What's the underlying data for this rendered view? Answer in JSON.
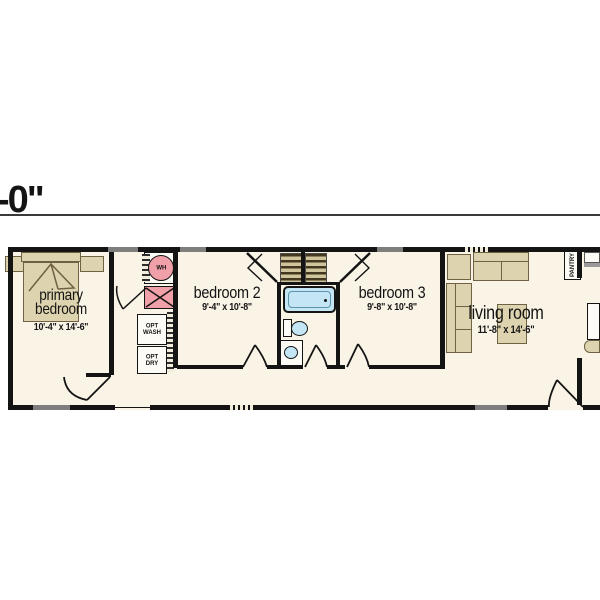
{
  "dimension_label": "-0\"",
  "rooms": {
    "primary": {
      "label": "primary bedroom",
      "dims": "10'-4\" x 14'-6\""
    },
    "bedroom2": {
      "label": "bedroom 2",
      "dims": "9'-4\" x 10'-8\""
    },
    "bedroom3": {
      "label": "bedroom 3",
      "dims": "9'-8\" x 10'-8\""
    },
    "living": {
      "label": "living room",
      "dims": "11'-8\" x 14'-6\""
    }
  },
  "fixtures": {
    "water_heater_label": "WH",
    "opt_washer_label": "OPT WASH",
    "opt_dryer_label": "OPT DRY",
    "pantry_label": "PANTRY"
  },
  "colors": {
    "floor": "#faf4e7",
    "wall": "#141414",
    "furniture_tan": "#ddd3ae",
    "utility_pink": "#f0a0a8",
    "plumbing_blue": "#c3e5f4",
    "window_gray": "#7e7e7e"
  }
}
